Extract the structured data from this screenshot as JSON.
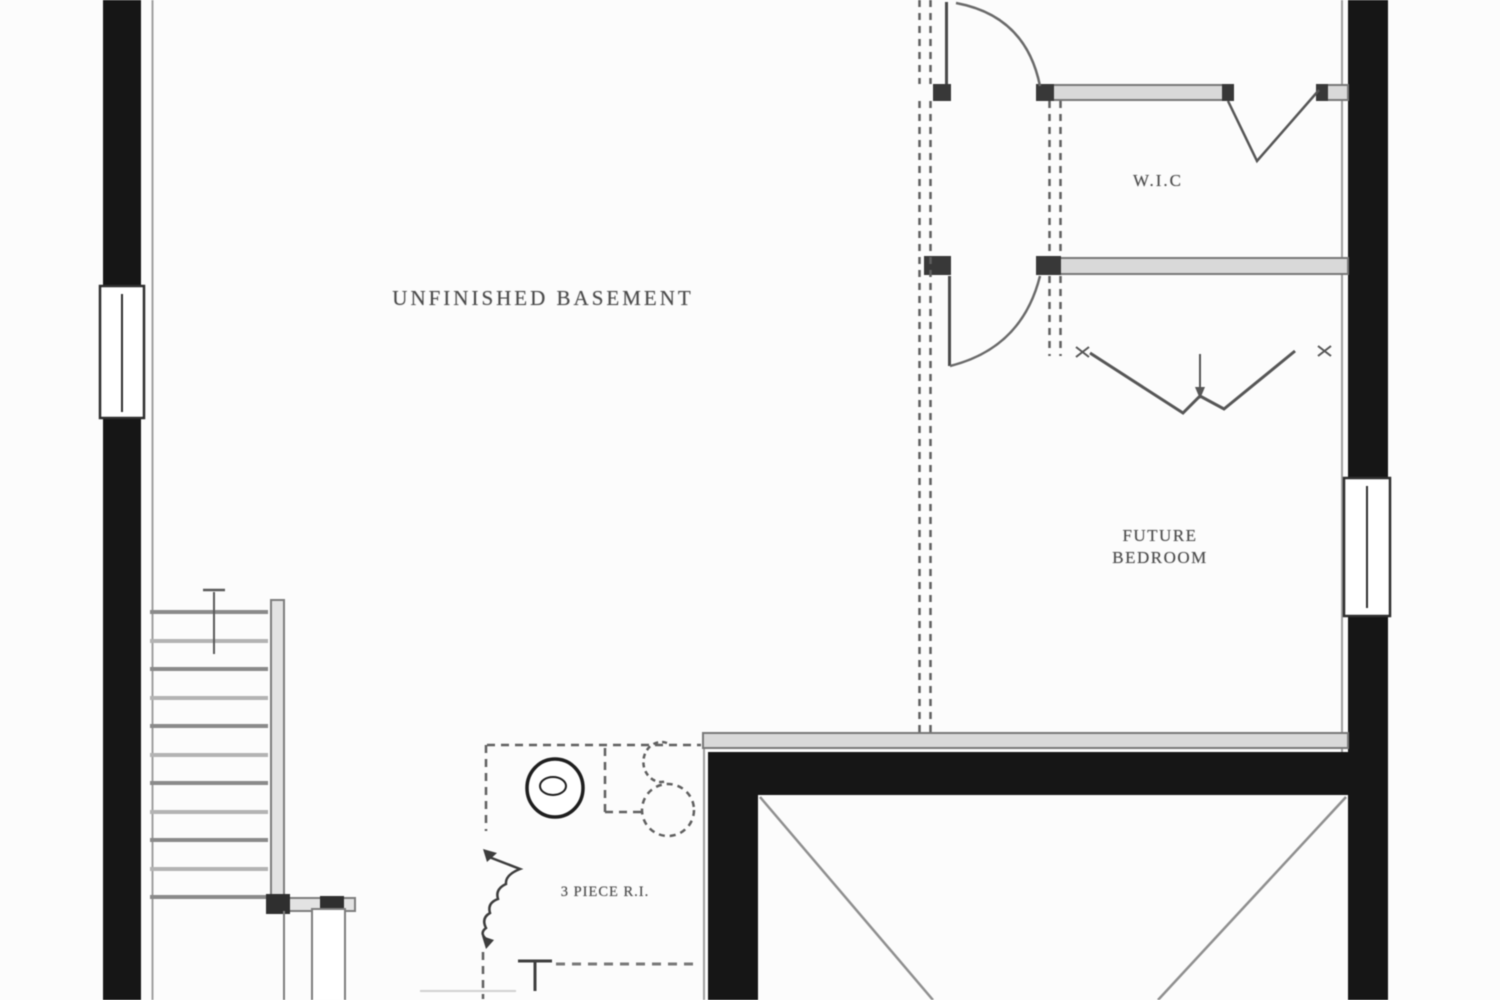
{
  "plan": {
    "type": "basement-floor-plan",
    "rooms": [
      {
        "id": "unfinished-basement",
        "label": "UNFINISHED BASEMENT"
      },
      {
        "id": "walk-in-closet",
        "label": "W.I.C"
      },
      {
        "id": "future-bedroom",
        "label_line1": "FUTURE",
        "label_line2": "BEDROOM"
      },
      {
        "id": "bath-rough-in",
        "label": "3 PIECE R.I."
      }
    ],
    "symbols": [
      "stairs",
      "stair-direction-arrow",
      "door-swing",
      "bifold-door",
      "window",
      "toilet-rough-in",
      "floor-drain",
      "sink-rough-in",
      "plumbing-squiggle",
      "shower-rough-in",
      "unexcavated-x-bracing",
      "future-wall-dashed",
      "zigzag-beam-symbol"
    ],
    "colors": {
      "exterior_wall": "#161616",
      "interior_wall_fill": "#d9d9d9",
      "interior_wall_edge": "#787878",
      "dashed_line": "#5f5f5f",
      "diagonal": "#8f8f8f",
      "text": "#4a4a4a",
      "background": "#fcfcfc"
    }
  }
}
